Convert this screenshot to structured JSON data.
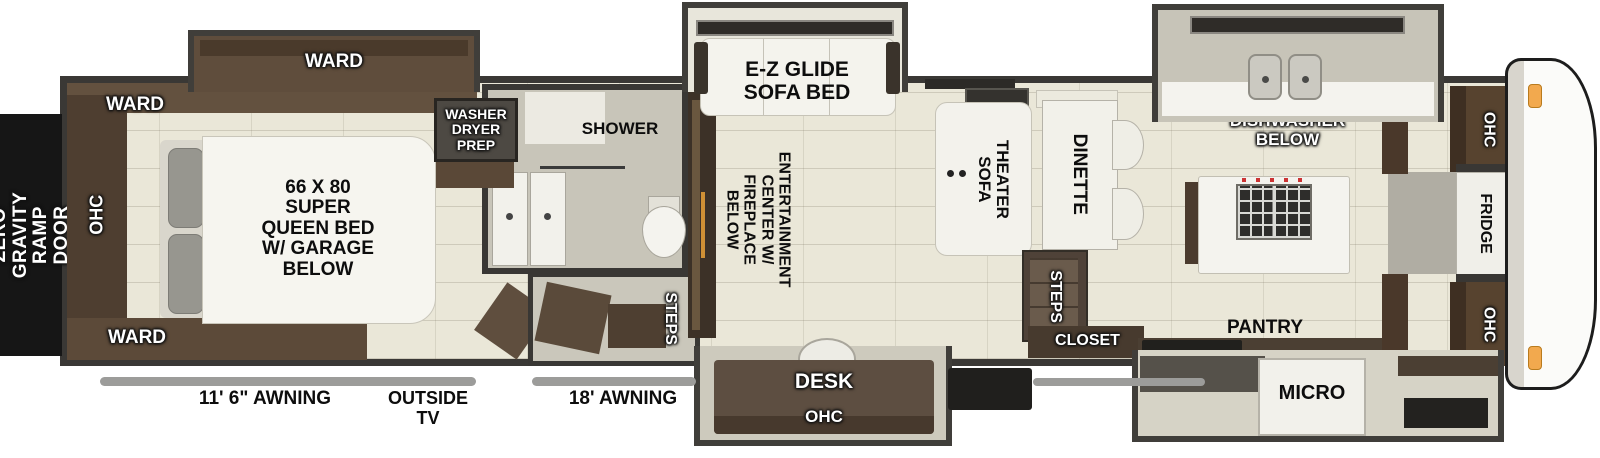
{
  "diagram_type": "rv-fifth-wheel-floorplan",
  "colors": {
    "wall": "#3a3835",
    "floor": "#eae7d8",
    "cabinet": "#5d4b3a",
    "cabinet_dark": "#4a392b",
    "slide_wall": "#403e3a",
    "ramp_door": "#161616",
    "awning_bar": "#9c9c9a",
    "marker_light": "#f2a94e",
    "white_goods": "#f4f3ee"
  },
  "exterior": {
    "ramp_door_label": "ZERO GRAVITY\nRAMP DOOR",
    "awning_left_label": "11' 6\" AWNING",
    "outside_tv_label": "OUTSIDE\nTV",
    "awning_right_label": "18' AWNING"
  },
  "bedroom": {
    "ward_slide_label": "WARD",
    "ward_upper_label": "WARD",
    "ward_lower_label": "WARD",
    "ohc_label": "OHC",
    "bed_label": "66 X 80\nSUPER\nQUEEN BED\nW/ GARAGE\nBELOW"
  },
  "bath": {
    "washer_label": "WASHER\nDRYER\nPREP",
    "shower_label": "SHOWER",
    "steps_label": "STEPS"
  },
  "living": {
    "entertainment_label": "ENTERTAINMENT\nCENTER W/\nFIREPLACE BELOW",
    "sofa_bed_label": "E-Z GLIDE\nSOFA BED",
    "theater_sofa_label": "THEATER\nSOFA",
    "dinette_label": "DINETTE",
    "steps_label": "STEPS",
    "closet_label": "CLOSET",
    "desk_label": "DESK",
    "desk_ohc_label": "OHC"
  },
  "kitchen": {
    "dishwasher_label": "DISHWASHER\nBELOW",
    "pantry_label": "PANTRY",
    "micro_label": "MICRO",
    "ohc_top_label": "OHC",
    "fridge_label": "FRIDGE",
    "ohc_bottom_label": "OHC"
  }
}
